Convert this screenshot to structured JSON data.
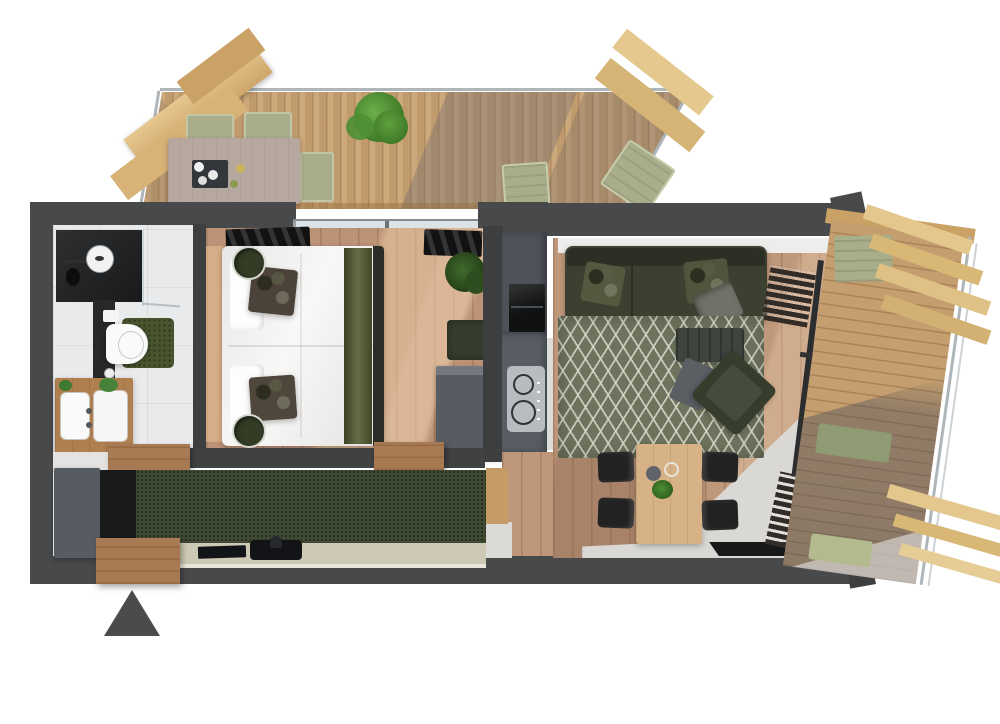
{
  "scene": {
    "kind": "3d-apartment-floor-plan-top-view",
    "background": "#ffffff",
    "entrance_arrow_color": "#4b4b4b"
  },
  "palette": {
    "wall": "#47494b",
    "wall_dark": "#3c3e40",
    "wall_hall": "#3f4143",
    "deck_wood": "#c7a172",
    "deck_wood_east": "#c49e6f",
    "pergola_wood": "#e0c088",
    "pergola_wood_dark": "#caa265",
    "railing_glass": "#aeb6ba",
    "interior_wood": "#bd9377",
    "living_wood": "#bf977a",
    "tile": "#e9eaec",
    "light_floor": "#dad8d5",
    "white_strip": "#ededec",
    "bed_linen": "#f4f3f1",
    "bed_runner": "#50592f",
    "stool_green": "#343c25",
    "stool_ring": "#d6d8d0",
    "curtain_black": "#1b1b1b",
    "sofa_green": "#3b4030",
    "pillow_gray": "#70726a",
    "rug_green": "#6e735d",
    "coffee_table": "#3f443f",
    "armchair_green": "#363d2d",
    "footstool_gray": "#5b5f64",
    "dining_table_wood": "#d6b286",
    "chair_black": "#222222",
    "kitchen_cabinet": "#4d5359",
    "kitchen_counter": "#575d63",
    "oven_black": "#0f1113",
    "hob_panel": "#b7bcc0",
    "green_cabinet": "#3f4a33",
    "worktop": "#cdc9b4",
    "appliance_black": "#131417",
    "box_gray": "#575c63",
    "vanity_wood": "#b07f4f",
    "ceramic_white": "#fafafa",
    "bath_mat_green": "#49552e",
    "shower_dark": "#202224",
    "glass_pane": "rgba(200,212,218,0.65)",
    "cushion_green": "#a9ae8a",
    "cushion_green_dark": "#8f9b73",
    "plant_green": "#4f8f35",
    "plant_dark": "#2f4e1f",
    "table_outdoor": "#b6a89e",
    "threshold_wood": "#a87a54",
    "doormat_black": "#17181a"
  },
  "rooms": [
    {
      "id": "north_terrace",
      "furniture": [
        "wood-deck",
        "glass-railing",
        "pergola-beams",
        "outdoor-dining-table",
        "outdoor-chair",
        "outdoor-chair",
        "outdoor-chair",
        "potted-shrub",
        "sun-lounger",
        "sun-lounger"
      ]
    },
    {
      "id": "bathroom",
      "furniture": [
        "walk-in-shower",
        "rain-shower-head",
        "glass-partition",
        "toilet",
        "bath-mat",
        "double-vanity",
        "basin",
        "basin",
        "plant",
        "plant"
      ]
    },
    {
      "id": "bedroom",
      "furniture": [
        "double-bed",
        "pillows",
        "accent-cushion",
        "accent-cushion",
        "bed-runner",
        "round-side-table",
        "round-side-table",
        "curtain",
        "curtain",
        "potted-plant",
        "ottoman",
        "wardrobe"
      ]
    },
    {
      "id": "kitchen",
      "furniture": [
        "tall-cabinet",
        "built-in-oven",
        "counter",
        "induction-hob",
        "green-base-cabinets",
        "worktop",
        "sink-with-faucet",
        "refrigerator-cabinet"
      ]
    },
    {
      "id": "living_dining",
      "furniture": [
        "corner-sofa",
        "scatter-cushion",
        "scatter-cushion",
        "scatter-cushion",
        "lattice-rug",
        "coffee-table",
        "armchair",
        "footstool",
        "slatted-side-table",
        "slatted-bench",
        "dining-table",
        "dining-chair",
        "dining-chair",
        "dining-chair",
        "dining-chair",
        "table-plant",
        "bowl",
        "doormat"
      ]
    },
    {
      "id": "east_terrace",
      "furniture": [
        "wood-deck",
        "glass-railing",
        "pergola-beams",
        "seat-cushion",
        "seat-cushion",
        "seat-cushion"
      ]
    },
    {
      "id": "entrance",
      "furniture": [
        "wood-threshold",
        "direction-arrow"
      ]
    }
  ]
}
